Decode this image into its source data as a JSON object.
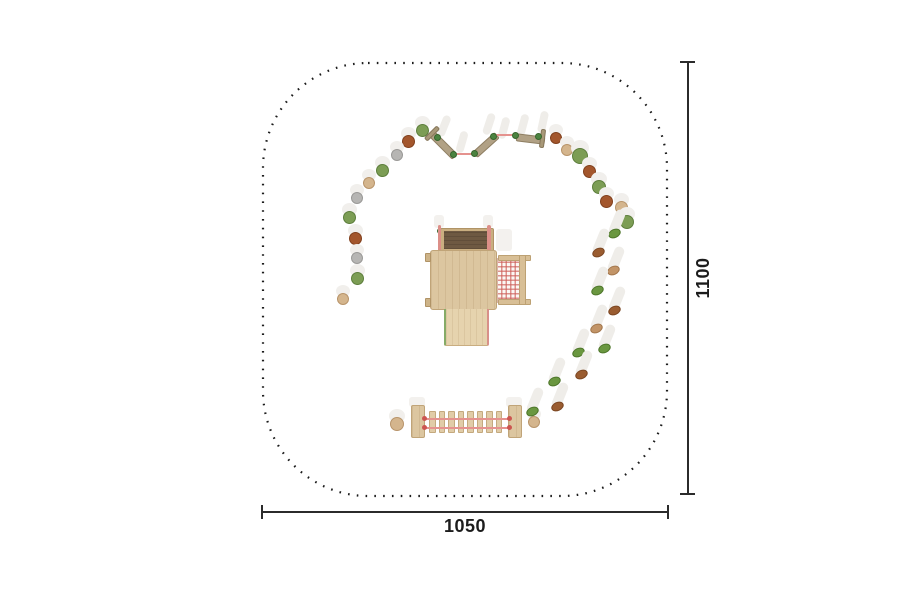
{
  "page": {
    "width": 900,
    "height": 600,
    "background": "#ffffff"
  },
  "boundary": {
    "x": 263,
    "y": 63,
    "width": 404,
    "height": 433,
    "corner_radius": 105,
    "dot_color": "#1b1b1b",
    "style": "dotted"
  },
  "dimensions": {
    "bottom": {
      "label": "1050"
    },
    "right": {
      "label": "1100"
    },
    "color": "#2b2b2b"
  },
  "palette": {
    "stone": {
      "green": {
        "fill": "#7c9d54",
        "border": "#5d7e3c"
      },
      "brown": {
        "fill": "#a3562c",
        "border": "#81401d"
      },
      "gray": {
        "fill": "#b6b5b3",
        "border": "#9a9997"
      },
      "beige": {
        "fill": "#d4b58d",
        "border": "#b8946a"
      }
    },
    "pod": {
      "green": {
        "fill": "#6a9740",
        "border": "#4d7529"
      },
      "brown": {
        "fill": "#9a5c30",
        "border": "#7a4521"
      },
      "tan": {
        "fill": "#c29467",
        "border": "#a2764c"
      }
    },
    "hold": {
      "blue": "#3566c4",
      "red": "#c93b32",
      "yellow": "#e6a31e",
      "orange": "#dd7a22"
    },
    "wood": "#dcc6a0",
    "roof": "#6e5942",
    "beam": "#b1a185",
    "rope": "#e5928e",
    "net_line": "#cd5c56",
    "green_dot": "#4b8340"
  },
  "stepping_stones": [
    {
      "x": 408,
      "y": 141,
      "r": 6.5,
      "c": "brown"
    },
    {
      "x": 397,
      "y": 155,
      "r": 6.0,
      "c": "gray"
    },
    {
      "x": 382,
      "y": 170,
      "r": 6.5,
      "c": "green"
    },
    {
      "x": 369,
      "y": 183,
      "r": 6.0,
      "c": "beige"
    },
    {
      "x": 357,
      "y": 198,
      "r": 6.0,
      "c": "gray"
    },
    {
      "x": 349,
      "y": 217,
      "r": 6.5,
      "c": "green"
    },
    {
      "x": 355,
      "y": 238,
      "r": 6.5,
      "c": "brown"
    },
    {
      "x": 357,
      "y": 258,
      "r": 6.0,
      "c": "gray"
    },
    {
      "x": 357,
      "y": 278,
      "r": 6.5,
      "c": "green"
    },
    {
      "x": 343,
      "y": 299,
      "r": 6.0,
      "c": "beige"
    },
    {
      "x": 422,
      "y": 130,
      "r": 6.5,
      "c": "green"
    },
    {
      "x": 556,
      "y": 138,
      "r": 6.0,
      "c": "brown"
    },
    {
      "x": 567,
      "y": 150,
      "r": 6.0,
      "c": "beige"
    },
    {
      "x": 580,
      "y": 156,
      "r": 8.0,
      "c": "green"
    },
    {
      "x": 589,
      "y": 171,
      "r": 6.5,
      "c": "brown"
    },
    {
      "x": 599,
      "y": 187,
      "r": 7.0,
      "c": "green"
    },
    {
      "x": 606,
      "y": 201,
      "r": 6.5,
      "c": "brown"
    },
    {
      "x": 621,
      "y": 207,
      "r": 6.5,
      "c": "beige"
    },
    {
      "x": 627,
      "y": 222,
      "r": 7.0,
      "c": "green"
    },
    {
      "x": 397,
      "y": 424,
      "r": 7.0,
      "c": "beige"
    },
    {
      "x": 534,
      "y": 422,
      "r": 6.0,
      "c": "beige"
    }
  ],
  "step_pods": [
    {
      "x": 614,
      "y": 233,
      "c": "green"
    },
    {
      "x": 598,
      "y": 252,
      "c": "brown"
    },
    {
      "x": 613,
      "y": 270,
      "c": "tan"
    },
    {
      "x": 597,
      "y": 290,
      "c": "green"
    },
    {
      "x": 614,
      "y": 310,
      "c": "brown"
    },
    {
      "x": 596,
      "y": 328,
      "c": "tan"
    },
    {
      "x": 604,
      "y": 348,
      "c": "green"
    },
    {
      "x": 578,
      "y": 352,
      "c": "green"
    },
    {
      "x": 581,
      "y": 374,
      "c": "brown"
    },
    {
      "x": 554,
      "y": 381,
      "c": "green"
    },
    {
      "x": 557,
      "y": 406,
      "c": "brown"
    },
    {
      "x": 532,
      "y": 411,
      "c": "green"
    }
  ],
  "balance_course": {
    "beams": [
      {
        "cx": 443,
        "cy": 145,
        "len": 34,
        "w": 8,
        "angle": 45
      },
      {
        "cx": 486,
        "cy": 145,
        "len": 30,
        "w": 8,
        "angle": -42
      },
      {
        "cx": 530,
        "cy": 139,
        "len": 29,
        "w": 8,
        "angle": 7
      }
    ],
    "caps": [
      {
        "cx": 432,
        "cy": 133,
        "len": 18,
        "w": 5,
        "angle": -45
      },
      {
        "cx": 542,
        "cy": 138,
        "len": 19,
        "w": 5,
        "angle": 97
      }
    ],
    "ropes": [
      {
        "x1": 455,
        "y1": 154,
        "x2": 474,
        "y2": 154
      },
      {
        "x1": 496,
        "y1": 135,
        "x2": 515,
        "y2": 135
      }
    ],
    "dots": [
      {
        "x": 437,
        "y": 137
      },
      {
        "x": 453,
        "y": 154
      },
      {
        "x": 474,
        "y": 153
      },
      {
        "x": 493,
        "y": 136
      },
      {
        "x": 515,
        "y": 135
      },
      {
        "x": 538,
        "y": 136
      }
    ],
    "post_shadows": [
      {
        "cx": 444,
        "cy": 126,
        "angle": 22
      },
      {
        "cx": 462,
        "cy": 142,
        "angle": 16
      },
      {
        "cx": 489,
        "cy": 124,
        "angle": 18
      },
      {
        "cx": 504,
        "cy": 128,
        "angle": 15
      },
      {
        "cx": 523,
        "cy": 125,
        "angle": 15
      },
      {
        "cx": 543,
        "cy": 122,
        "angle": 12
      }
    ]
  },
  "tower": {
    "corner_dots": [
      {
        "x": 441,
        "y": 257,
        "r": 4
      },
      {
        "x": 487,
        "y": 257,
        "r": 4
      },
      {
        "x": 441,
        "y": 303,
        "r": 4
      },
      {
        "x": 487,
        "y": 303,
        "r": 4
      },
      {
        "x": 440,
        "y": 231,
        "r": 3
      },
      {
        "x": 488,
        "y": 231,
        "r": 3
      }
    ],
    "holds": [
      {
        "x": 456,
        "y": 318,
        "c": "blue"
      },
      {
        "x": 462,
        "y": 321,
        "c": "red"
      },
      {
        "x": 471,
        "y": 315,
        "c": "yellow"
      },
      {
        "x": 480,
        "y": 319,
        "c": "red"
      },
      {
        "x": 452,
        "y": 328,
        "c": "orange"
      },
      {
        "x": 473,
        "y": 326,
        "c": "orange"
      },
      {
        "x": 454,
        "y": 337,
        "c": "yellow"
      },
      {
        "x": 463,
        "y": 340,
        "c": "red"
      },
      {
        "x": 475,
        "y": 336,
        "c": "blue"
      },
      {
        "x": 482,
        "y": 331,
        "c": "yellow"
      }
    ]
  },
  "bridge": {
    "rung_xs": [
      429,
      438.5,
      448,
      457.5,
      467,
      476.5,
      486,
      495.5
    ],
    "rung_y": 411,
    "rung_h": 22,
    "rung_w": 6.5,
    "rope_ys": [
      418.5,
      427.5
    ],
    "rope_x1": 423,
    "rope_x2": 510
  }
}
